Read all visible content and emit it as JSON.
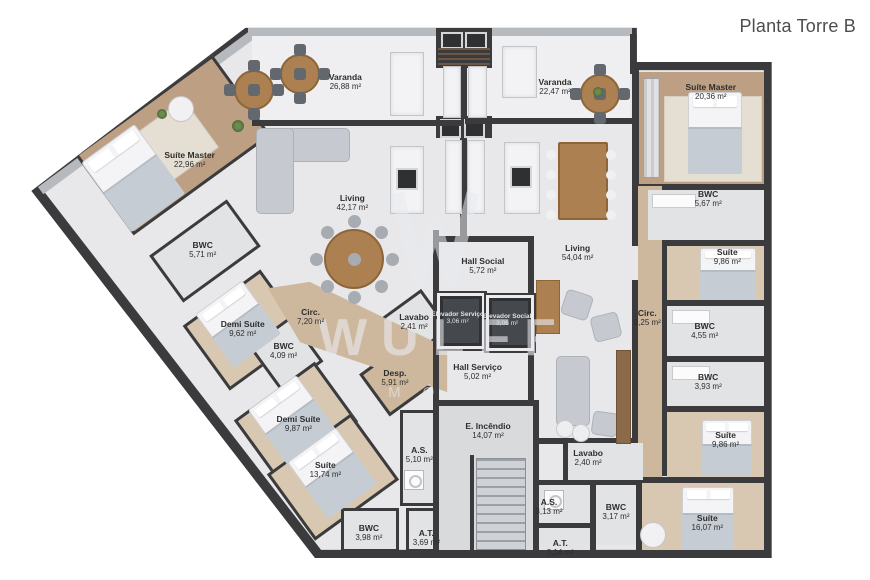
{
  "title": "Planta Torre B",
  "watermark": {
    "brand": "WULFF",
    "subtitle": "IMÓVEIS"
  },
  "rooms": [
    {
      "group": "apartment-left",
      "name": "Varanda",
      "area": "26,88 m²",
      "x": 39.7,
      "y": 14.1
    },
    {
      "group": "apartment-left",
      "name": "Suíte Master",
      "area": "22,96 m²",
      "x": 21.8,
      "y": 27.6
    },
    {
      "group": "apartment-left",
      "name": "Living",
      "area": "42,17 m²",
      "x": 40.5,
      "y": 35.0
    },
    {
      "group": "apartment-left",
      "name": "BWC",
      "area": "5,71 m²",
      "x": 23.3,
      "y": 43.1
    },
    {
      "group": "apartment-left",
      "name": "Demi Suíte",
      "area": "9,62 m²",
      "x": 27.9,
      "y": 56.7
    },
    {
      "group": "apartment-left",
      "name": "Circ.",
      "area": "7,20 m²",
      "x": 35.7,
      "y": 54.7
    },
    {
      "group": "apartment-left",
      "name": "Lavabo",
      "area": "2,41 m²",
      "x": 47.6,
      "y": 55.5
    },
    {
      "group": "apartment-left",
      "name": "BWC",
      "area": "4,09 m²",
      "x": 32.6,
      "y": 60.5
    },
    {
      "group": "apartment-left",
      "name": "Desp.",
      "area": "5,91 m²",
      "x": 45.4,
      "y": 65.2
    },
    {
      "group": "apartment-left",
      "name": "Demi Suíte",
      "area": "9,87 m²",
      "x": 34.3,
      "y": 73.1
    },
    {
      "group": "apartment-left",
      "name": "Suíte",
      "area": "13,74 m²",
      "x": 37.4,
      "y": 81.0
    },
    {
      "group": "apartment-left",
      "name": "A.S.",
      "area": "5,10 m²",
      "x": 48.2,
      "y": 78.4
    },
    {
      "group": "apartment-left",
      "name": "BWC",
      "area": "3,98 m²",
      "x": 42.4,
      "y": 91.9
    },
    {
      "group": "apartment-left",
      "name": "A.T.",
      "area": "3,69 m²",
      "x": 49.0,
      "y": 92.8
    },
    {
      "group": "core",
      "name": "Hall Social",
      "area": "5,72 m²",
      "x": 55.5,
      "y": 45.9
    },
    {
      "group": "core",
      "name": "Elevador Serviço",
      "area": "3,06 m²",
      "x": 52.6,
      "y": 54.8,
      "variant": "elevator"
    },
    {
      "group": "core",
      "name": "Elevador Social",
      "area": "3,06 m²",
      "x": 58.3,
      "y": 55.1,
      "variant": "elevator"
    },
    {
      "group": "core",
      "name": "Hall Serviço",
      "area": "5,02 m²",
      "x": 54.9,
      "y": 64.1
    },
    {
      "group": "core",
      "name": "E. Incêndio",
      "area": "14,07 m²",
      "x": 56.1,
      "y": 74.3
    },
    {
      "group": "apartment-right",
      "name": "Varanda",
      "area": "22,47 m²",
      "x": 63.8,
      "y": 15.0
    },
    {
      "group": "apartment-right",
      "name": "Living",
      "area": "54,04 m²",
      "x": 66.4,
      "y": 43.6
    },
    {
      "group": "apartment-right",
      "name": "Suíte Master",
      "area": "20,36 m²",
      "x": 81.7,
      "y": 15.9
    },
    {
      "group": "apartment-right",
      "name": "BWC",
      "area": "5,67 m²",
      "x": 81.4,
      "y": 34.3
    },
    {
      "group": "apartment-right",
      "name": "Suíte",
      "area": "9,86 m²",
      "x": 83.6,
      "y": 44.3
    },
    {
      "group": "apartment-right",
      "name": "Circ.",
      "area": "8,25 m²",
      "x": 74.4,
      "y": 54.8
    },
    {
      "group": "apartment-right",
      "name": "BWC",
      "area": "4,55 m²",
      "x": 81.0,
      "y": 57.1
    },
    {
      "group": "apartment-right",
      "name": "BWC",
      "area": "3,93 m²",
      "x": 81.4,
      "y": 65.9
    },
    {
      "group": "apartment-right",
      "name": "Suíte",
      "area": "9,86 m²",
      "x": 83.4,
      "y": 75.9
    },
    {
      "group": "apartment-right",
      "name": "Lavabo",
      "area": "2,40 m²",
      "x": 67.6,
      "y": 79.0
    },
    {
      "group": "apartment-right",
      "name": "A.S.",
      "area": "3,13 m²",
      "x": 63.1,
      "y": 87.4
    },
    {
      "group": "apartment-right",
      "name": "BWC",
      "area": "3,17 m²",
      "x": 70.8,
      "y": 88.3
    },
    {
      "group": "apartment-right",
      "name": "A.T.",
      "area": "3,14 m²",
      "x": 64.4,
      "y": 94.5
    },
    {
      "group": "apartment-right",
      "name": "Suíte",
      "area": "16,07 m²",
      "x": 81.3,
      "y": 90.2
    }
  ]
}
